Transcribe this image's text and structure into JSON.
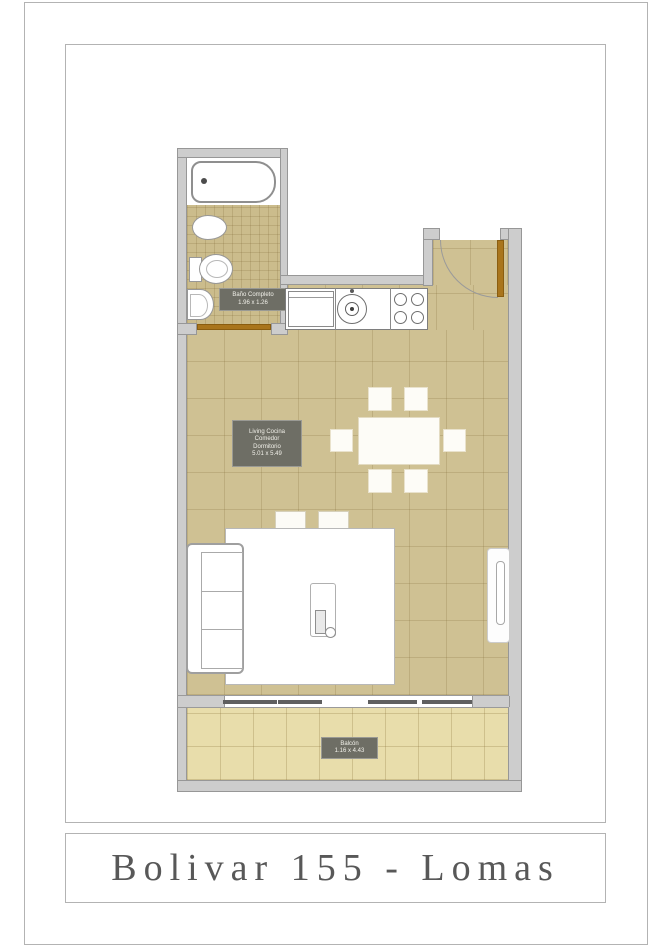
{
  "title_plate": {
    "text": "Bolivar 155 - Lomas"
  },
  "plan": {
    "rooms": {
      "bathroom": {
        "label_line1": "Baño Completo",
        "label_line2": "1.96 x 1.26"
      },
      "living": {
        "label_line1": "Living Cocina",
        "label_line2": "Comedor",
        "label_line3": "Dormitorio",
        "label_line4": "5.01 x 5.49"
      },
      "balcony": {
        "label_line1": "Balcón",
        "label_line2": "1.16 x 4.43"
      }
    },
    "colors": {
      "floor_interior": "#cfc193",
      "floor_bathroom": "#cbbc8c",
      "floor_balcony": "#e8ddab",
      "wall_fill": "#cdcdcd",
      "wall_outline": "#979797",
      "label_bg": "#6e6e65",
      "door_leaf": "#a9751c",
      "title_text": "#585858"
    }
  }
}
